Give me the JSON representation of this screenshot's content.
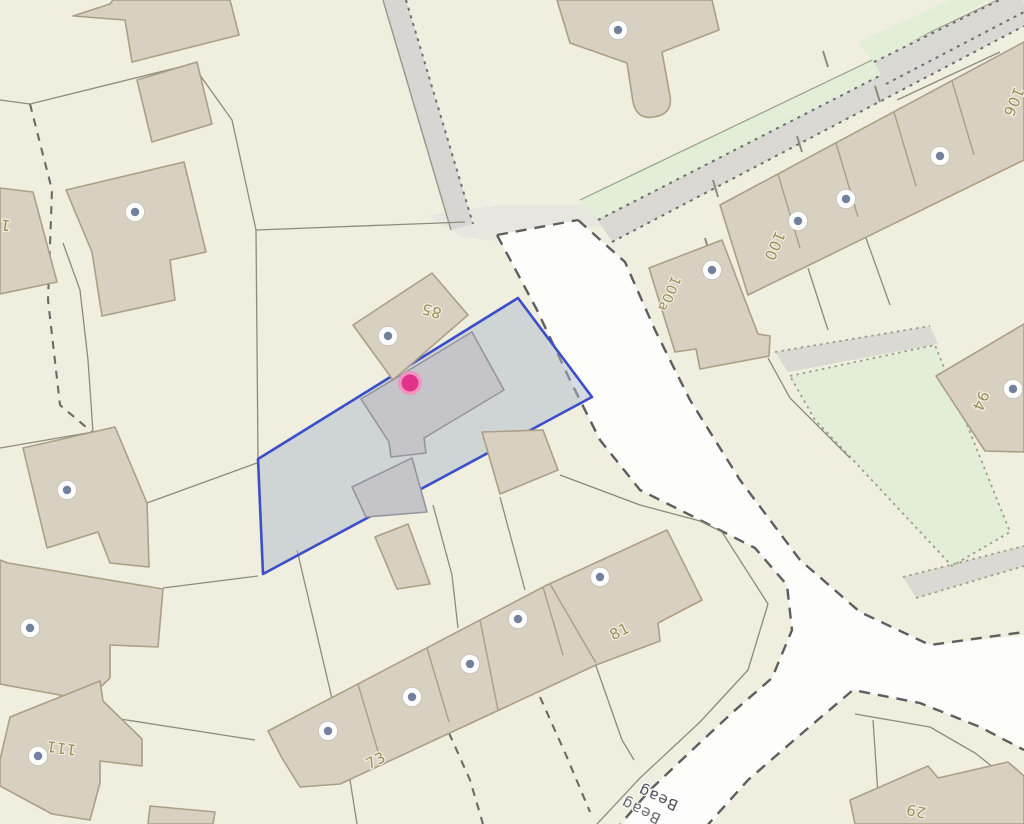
{
  "map": {
    "description": "Cadastral map view with one selected land parcel and a dropped pin",
    "selected_parcel": {
      "outline_color": "#3a4fc8",
      "fill_color": "rgba(173,186,203,0.5)"
    },
    "pin": {
      "core_color": "#e2338c",
      "ring_color": "#f095c0"
    },
    "entrance_marker": {
      "circle_color": "#ffffff",
      "dot_color": "#72819e"
    },
    "labels": [
      {
        "text": "85"
      },
      {
        "text": "100"
      },
      {
        "text": "100a"
      },
      {
        "text": "106"
      },
      {
        "text": "94"
      },
      {
        "text": "81"
      },
      {
        "text": "73"
      },
      {
        "text": "111"
      },
      {
        "text": "29"
      },
      {
        "text": "1"
      }
    ],
    "street_label": {
      "text": "Beag"
    }
  },
  "colors": {
    "background_land": "#f0eedf",
    "building_fill": "#d8d0c0",
    "building_outline": "#ab9f87",
    "selected_building_fill": "#c5c4c9",
    "road_fill": "#fdfdfc",
    "road_casing": "#5e5e5e",
    "path_fill": "#d9d8d3",
    "grass_fill": "#e2eed8",
    "parcel_line": "#8c8c7d",
    "house_number_text": "#9c8e59",
    "street_name_text": "#50505c"
  }
}
